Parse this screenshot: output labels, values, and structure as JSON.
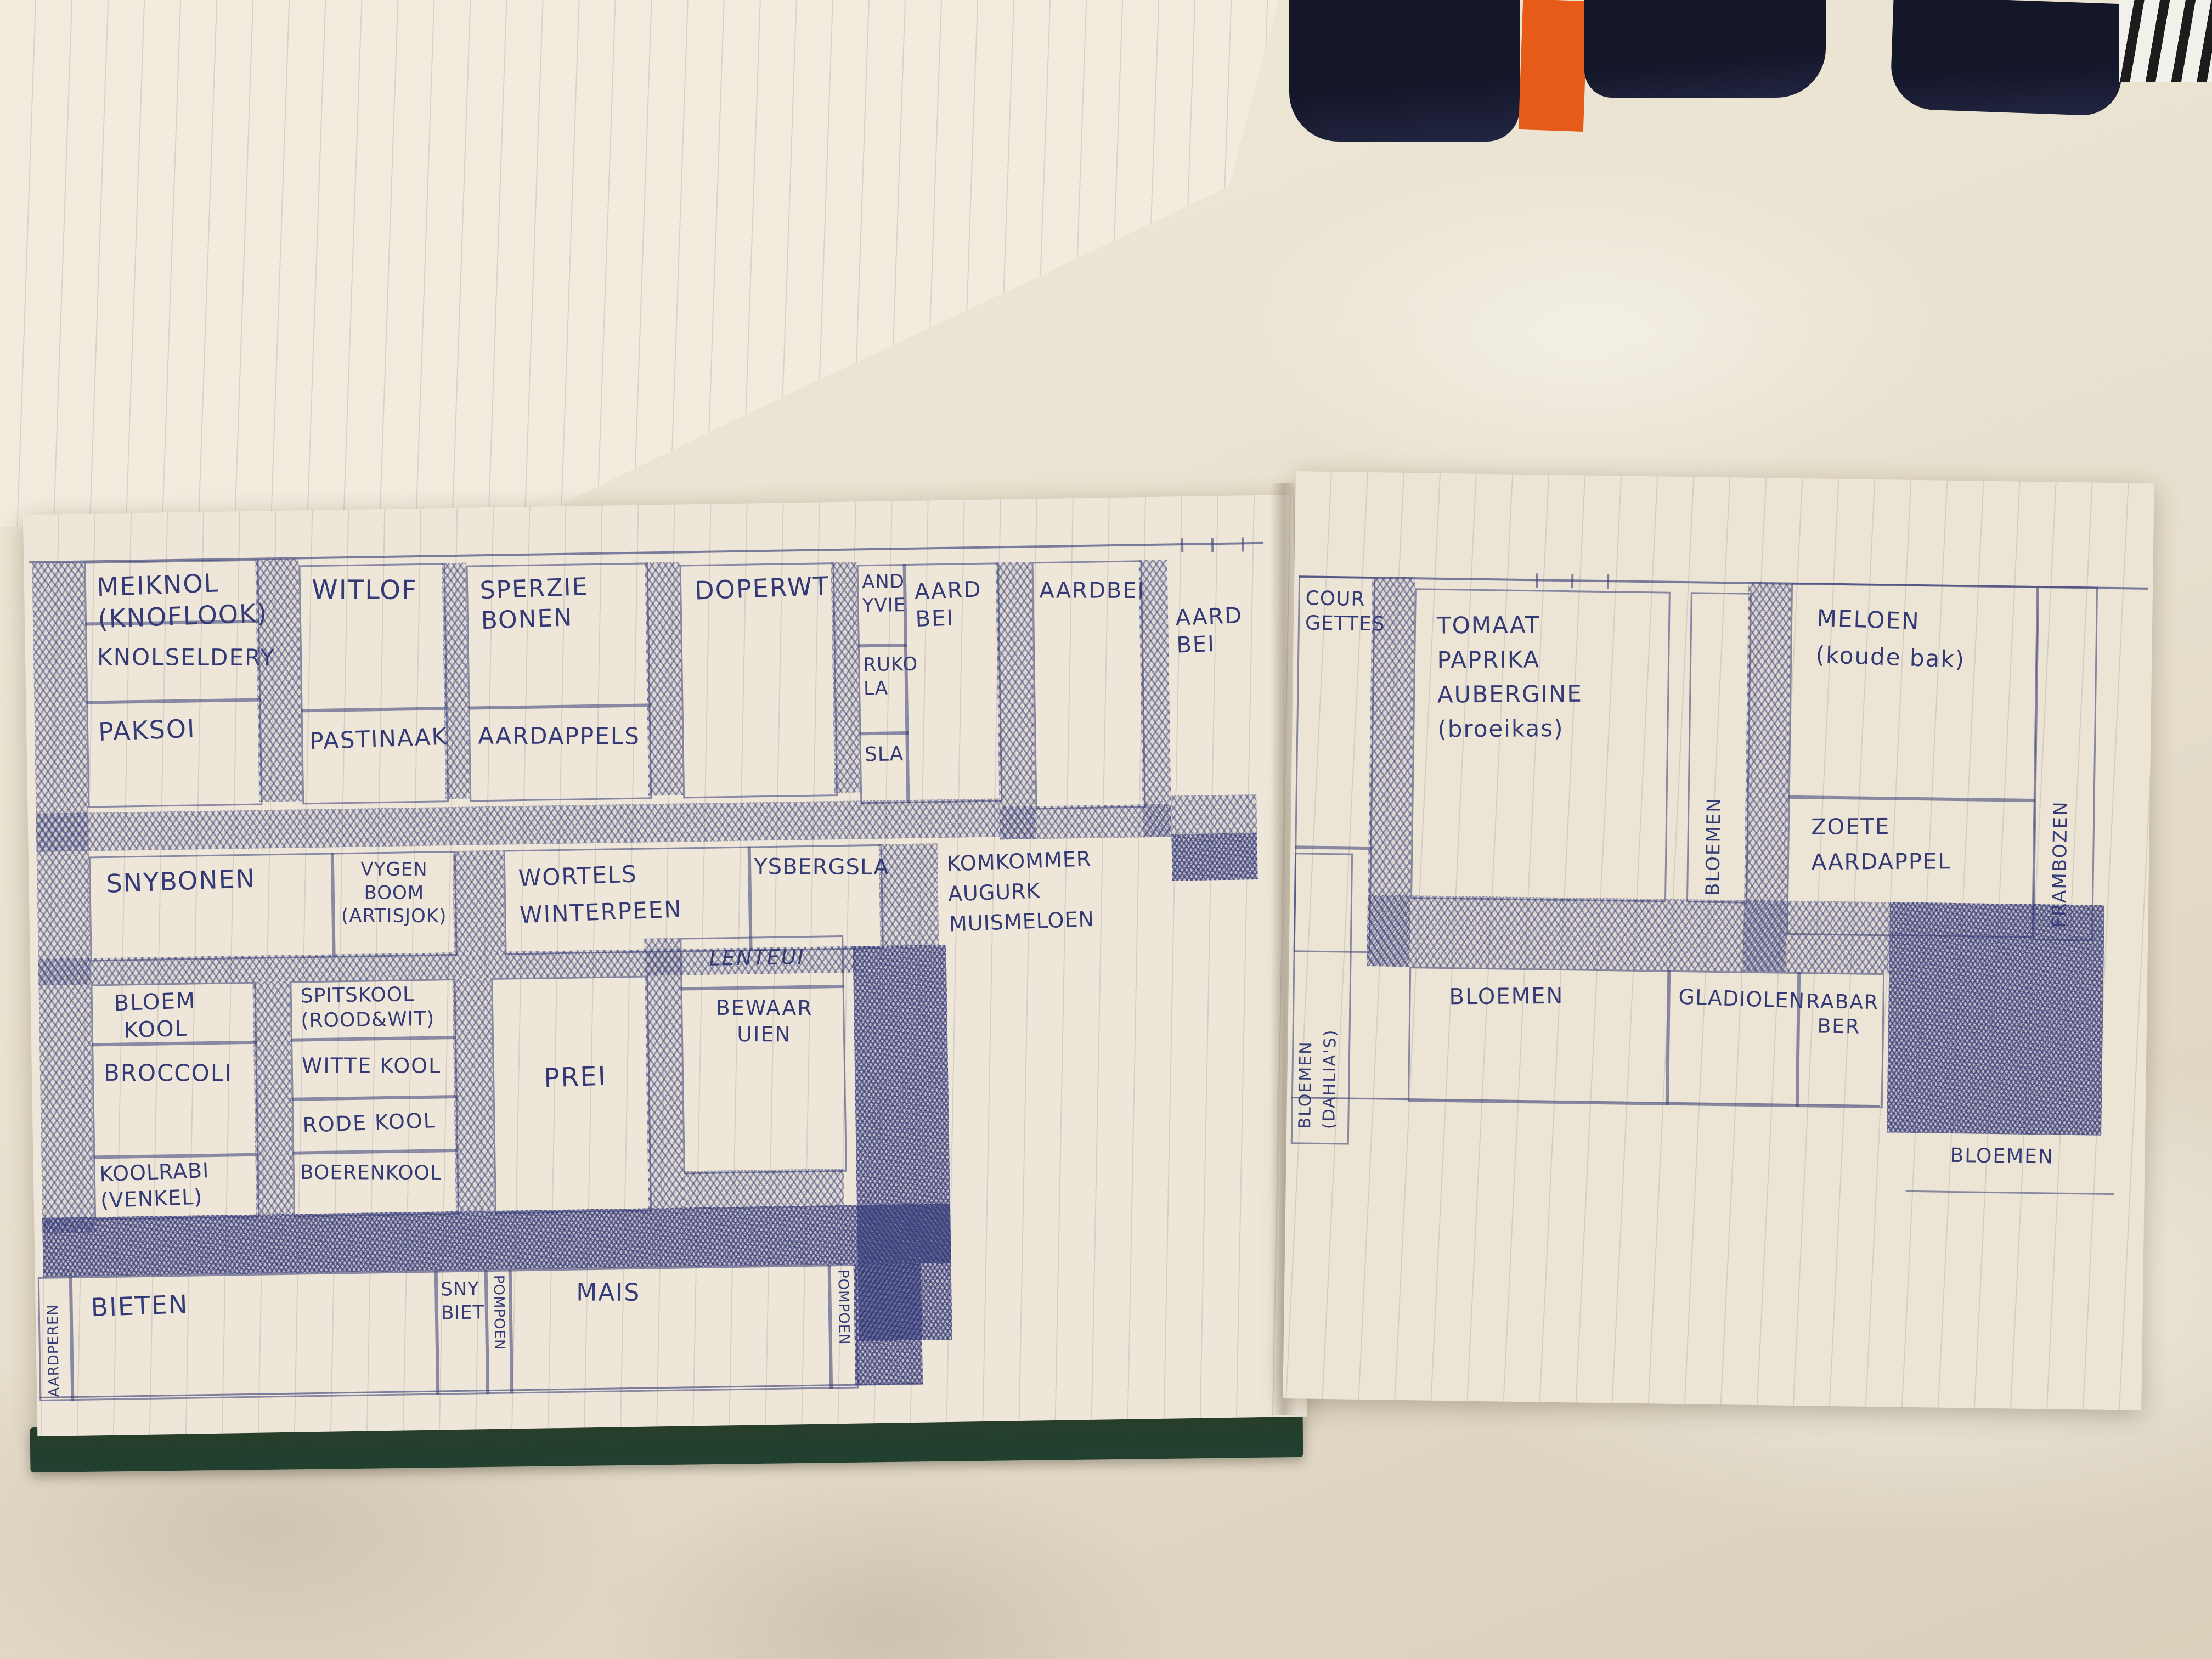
{
  "colors": {
    "ink_blue": "#343a75",
    "paper": "#eee7d9",
    "bed_sheet": "#e6dfcf",
    "notebook_cover_green": "#22402f",
    "fabric_navy": "#14162a",
    "strap_orange": "#e65b17"
  },
  "upper_page": {
    "note_1": "„9869",
    "note_2": "„4562"
  },
  "left_page": {
    "meiknol": "MEIKNOL\n(KNOFLOOK)",
    "knolselderij": "KNOLSELDERY",
    "paksoi": "PAKSOI",
    "witlof": "WITLOF",
    "pastinaak": "PASTINAAK",
    "sperziebonen": "SPERZIE\nBONEN",
    "aardappels": "AARDAPPELS",
    "doperwt": "DOPERWT",
    "andijvie": "AND\nYVIE",
    "rucola": "RUKO\nLA",
    "sla": "SLA",
    "aardbei_1": "AARD\nBEI",
    "aardbei_2": "AARDBEI",
    "aardbei_3": "AARD\nBEI",
    "snijbonen": "SNYBONEN",
    "vijgenboom": "VYGEN\nBOOM\n(ARTISJOK)",
    "wortels": "WORTELS\nWINTERPEEN",
    "ijsbergsla": "YSBERGSLA",
    "komkommer": "KOMKOMMER\nAUGURK\nMUISMELOEN",
    "bloemkool": "BLOEM\nKOOL",
    "broccoli": "BROCCOLI",
    "koolrabi": "KOOLRABI\n(VENKEL)",
    "spitskool": "SPITSKOOL\n(ROOD&WIT)",
    "wittekool": "WITTE KOOL",
    "rodekool": "RODE KOOL",
    "boerenkool": "BOERENKOOL",
    "prei": "PREI",
    "lenteui": "LENTEUI",
    "bewaaruien": "BEWAAR\nUIEN",
    "aardperen": "AARDPEREN",
    "bieten": "BIETEN",
    "snijbiet": "SNY\nBIET",
    "pompoen_links": "POMPOEN",
    "mais": "MAIS",
    "pompoen_rechts": "POMPOEN"
  },
  "right_page": {
    "courgettes": "COUR\nGETTES",
    "tomaat_kas": "TOMAAT\nPAPRIKA\nAUBERGINE\n(broeikas)",
    "bloemen_strook": "BLOEMEN",
    "meloen": "MELOEN\n(koude bak)",
    "zoete_aardappel": "ZOETE\nAARDAPPEL",
    "frambozen": "FRAMBOZEN",
    "bloemen_dahlias_1": "BLOEMEN",
    "bloemen_dahlias_2": "(DAHLIA'S)",
    "bloemen_onder": "BLOEMEN",
    "gladiolen": "GLADIOLEN",
    "rabarber": "RABAR\nBER",
    "bloemen_rechtsonder": "BLOEMEN"
  }
}
